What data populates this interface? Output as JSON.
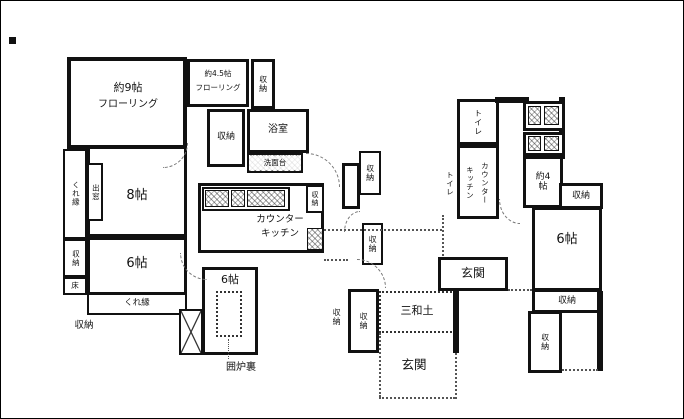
{
  "figure": {
    "type": "japanese-floor-plan",
    "style": "black-and-white scan"
  },
  "colors": {
    "wall": "#111111",
    "background": "#ffffff",
    "dotted_line": "#555555"
  },
  "labels": {
    "flooring9_l1": "約9帖",
    "flooring9_l2": "フローリング",
    "flooring45_l1": "約4.5帖",
    "flooring45_l2": "フローリング",
    "storage": "収納",
    "bath": "浴室",
    "washstand": "洗面台",
    "tokonoma": "床の間",
    "oshiire": "押入",
    "room8": "8帖",
    "bay_window": "出窓",
    "kureen": "くれ縁",
    "toko": "床",
    "room6": "6帖",
    "kitchen_l1": "カウンター",
    "kitchen_l2": "キッチン",
    "irori": "囲炉裏",
    "toilet": "トイレ",
    "room4": "約4帖",
    "genkan": "玄関",
    "tataki": "三和土"
  },
  "rooms": [
    {
      "name": "flooring-room-large",
      "label": "約9帖 フローリング"
    },
    {
      "name": "flooring-room-small",
      "label": "約4.5帖 フローリング"
    },
    {
      "name": "tatami-room-8",
      "label": "8帖"
    },
    {
      "name": "tatami-room-6-left",
      "label": "6帖"
    },
    {
      "name": "tatami-room-6-center",
      "label": "6帖"
    },
    {
      "name": "tatami-room-6-right",
      "label": "6帖"
    },
    {
      "name": "counter-kitchen",
      "label": "カウンターキッチン"
    },
    {
      "name": "bath",
      "label": "浴室"
    },
    {
      "name": "washstand",
      "label": "洗面台"
    },
    {
      "name": "toilet-1",
      "label": "トイレ"
    },
    {
      "name": "toilet-2",
      "label": "トイレ"
    },
    {
      "name": "room-4",
      "label": "約4帖"
    },
    {
      "name": "entrance-upper",
      "label": "玄関"
    },
    {
      "name": "entrance-lower",
      "label": "玄関"
    },
    {
      "name": "tataki",
      "label": "三和土"
    },
    {
      "name": "irori-hearth",
      "label": "囲炉裏"
    },
    {
      "name": "storage-closets",
      "label": "収納"
    },
    {
      "name": "veranda",
      "label": "くれ縁"
    },
    {
      "name": "bay-window",
      "label": "出窓"
    },
    {
      "name": "tokonoma",
      "label": "床の間"
    },
    {
      "name": "oshiire",
      "label": "押入"
    },
    {
      "name": "floor-alcove",
      "label": "床"
    }
  ]
}
